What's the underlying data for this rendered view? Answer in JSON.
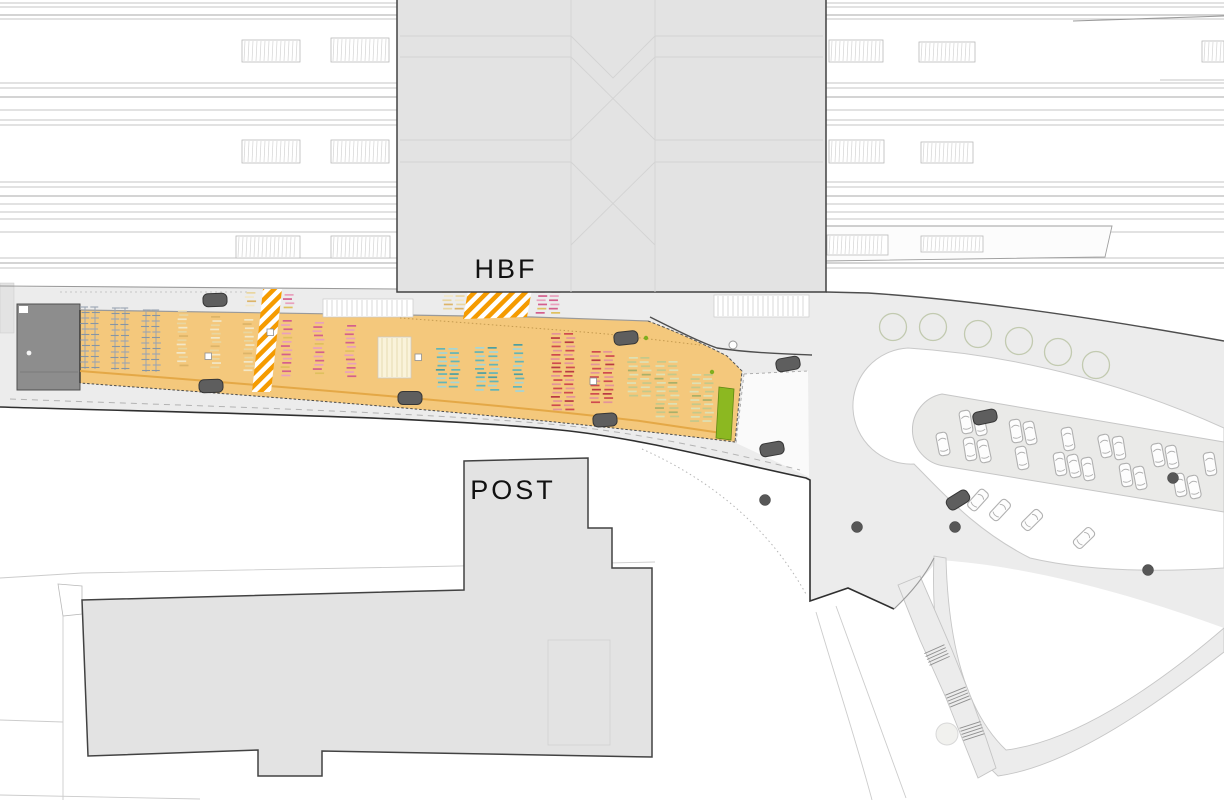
{
  "labels": {
    "hbf": "HBF",
    "post": "POST"
  },
  "colors": {
    "bg": "#ffffff",
    "building": "#e3e3e3",
    "buildingStroke": "#424242",
    "plaza": "#ececec",
    "deck": "#f4c87c",
    "deckLine": "#e2a440",
    "stripe": "#f59b00",
    "green": "#8cb821",
    "darkBox": "#8d8d8d",
    "carDark": "#5e5e5e",
    "tree": "#c2cab0",
    "dot": "#575757",
    "track": "#c6c6c6",
    "trackDark": "#a8a8a8",
    "label": "#111111"
  },
  "plan": {
    "track_segments": [
      [
        0,
        397
      ],
      [
        826,
        1224
      ]
    ],
    "track_ys_light": [
      3,
      7,
      19,
      83,
      88,
      110,
      120,
      125,
      182,
      187,
      204,
      212,
      219,
      232,
      258,
      268
    ],
    "track_ys_dark": [
      15,
      97,
      196,
      263
    ],
    "trains": [
      [
        242,
        40,
        58,
        22
      ],
      [
        331,
        38,
        58,
        24
      ],
      [
        242,
        140,
        58,
        23
      ],
      [
        331,
        140,
        58,
        23
      ],
      [
        236,
        236,
        64,
        22
      ],
      [
        331,
        236,
        59,
        22
      ],
      [
        829,
        40,
        54,
        22
      ],
      [
        919,
        42,
        56,
        20
      ],
      [
        829,
        140,
        55,
        23
      ],
      [
        921,
        142,
        52,
        21
      ],
      [
        827,
        235,
        61,
        20
      ],
      [
        921,
        236,
        62,
        16
      ],
      [
        1202,
        41,
        22,
        21
      ]
    ],
    "trees": [
      [
        893,
        327
      ],
      [
        933,
        327
      ],
      [
        978,
        334
      ],
      [
        1019,
        341
      ],
      [
        1058,
        352
      ],
      [
        1096,
        365
      ]
    ],
    "dots": [
      [
        765,
        500
      ],
      [
        857,
        527
      ],
      [
        955,
        527
      ],
      [
        1148,
        570
      ],
      [
        1173,
        478
      ]
    ],
    "green_dots": [
      [
        646,
        338
      ],
      [
        712,
        372
      ]
    ],
    "cars_dark": [
      [
        215,
        300,
        -2
      ],
      [
        211,
        386,
        -2
      ],
      [
        410,
        398,
        0
      ],
      [
        626,
        338,
        -6
      ],
      [
        788,
        364,
        -10
      ],
      [
        605,
        420,
        -4
      ],
      [
        772,
        449,
        -10
      ],
      [
        985,
        417,
        -12
      ],
      [
        958,
        500,
        -32
      ]
    ],
    "cars_island": [
      [
        966,
        422,
        -10
      ],
      [
        980,
        424,
        -12
      ],
      [
        1016,
        431,
        -9
      ],
      [
        1030,
        433,
        -11
      ],
      [
        1068,
        439,
        -10
      ],
      [
        1105,
        446,
        -12
      ],
      [
        1119,
        448,
        -9
      ],
      [
        1158,
        455,
        -11
      ],
      [
        1172,
        457,
        -10
      ],
      [
        1210,
        464,
        -9
      ],
      [
        943,
        444,
        -11
      ],
      [
        970,
        449,
        -9
      ],
      [
        984,
        451,
        -12
      ],
      [
        1022,
        458,
        -10
      ],
      [
        1060,
        464,
        -9
      ],
      [
        1074,
        466,
        -12
      ],
      [
        1088,
        469,
        -10
      ],
      [
        1126,
        475,
        -9
      ],
      [
        1140,
        478,
        -11
      ],
      [
        1180,
        485,
        -10
      ],
      [
        1194,
        487,
        -12
      ]
    ],
    "cars_taxi": [
      [
        978,
        500,
        42
      ],
      [
        1000,
        510,
        43
      ],
      [
        1032,
        520,
        45
      ],
      [
        1084,
        538,
        46
      ]
    ],
    "stairs": [
      [
        937,
        655,
        -24
      ],
      [
        958,
        697,
        -22
      ],
      [
        972,
        731,
        -18
      ]
    ],
    "stripe_bands": [
      [
        [
          263,
          289
        ],
        [
          282,
          289
        ],
        [
          271,
          392
        ],
        [
          252,
          392
        ]
      ],
      [
        [
          468,
          291
        ],
        [
          532,
          289
        ],
        [
          527,
          317
        ],
        [
          463,
          319
        ]
      ]
    ],
    "markers": [
      [
        208,
        356
      ],
      [
        270,
        332
      ],
      [
        418,
        357
      ],
      [
        593,
        381
      ]
    ],
    "palettes": {
      "rack": [
        "#9aa5b2",
        "#8795a4"
      ],
      "cream": [
        "#e9d6a0",
        "#f2e7c6",
        "#dcb469"
      ],
      "pink": [
        "#d45f8d",
        "#e9a0bd",
        "#dfc05e"
      ],
      "teal": [
        "#62b5b8",
        "#a3d6d7",
        "#4d9fa2"
      ],
      "red": [
        "#cf4a4f",
        "#e4939a",
        "#b93a44"
      ],
      "olive": [
        "#c3c98b",
        "#dde1b5",
        "#a8b06a"
      ]
    },
    "slot_fills": {
      "paleyellow": [
        "#faf3da",
        "#e0d5a8"
      ],
      "white": [
        "#ffffff",
        "#cfcfcf"
      ]
    },
    "bike_groups": [
      {
        "x": 82,
        "y": 307,
        "w": 16,
        "h": 62,
        "type": "rack"
      },
      {
        "x": 112,
        "y": 308,
        "w": 16,
        "h": 62,
        "type": "rack"
      },
      {
        "x": 143,
        "y": 310,
        "w": 18,
        "h": 62,
        "type": "rack"
      },
      {
        "x": 177,
        "y": 310,
        "w": 17,
        "h": 55,
        "type": "bikes",
        "color": "cream"
      },
      {
        "x": 210,
        "y": 316,
        "w": 17,
        "h": 54,
        "type": "bikes",
        "color": "cream"
      },
      {
        "x": 243,
        "y": 319,
        "w": 16,
        "h": 54,
        "type": "bikes",
        "color": "cream"
      },
      {
        "x": 245,
        "y": 292,
        "w": 16,
        "h": 16,
        "type": "bikes",
        "color": "cream"
      },
      {
        "x": 283,
        "y": 294,
        "w": 19,
        "h": 16,
        "type": "bikes",
        "color": "pink"
      },
      {
        "x": 281,
        "y": 320,
        "w": 19,
        "h": 56,
        "type": "bikes",
        "color": "pink"
      },
      {
        "x": 313,
        "y": 322,
        "w": 16,
        "h": 54,
        "type": "bikes",
        "color": "pink"
      },
      {
        "x": 345,
        "y": 325,
        "w": 17,
        "h": 52,
        "type": "bikes",
        "color": "pink"
      },
      {
        "x": 378,
        "y": 337,
        "w": 33,
        "h": 41,
        "type": "slots",
        "fill": "paleyellow"
      },
      {
        "x": 323,
        "y": 299,
        "w": 90,
        "h": 18,
        "type": "slots",
        "fill": "white"
      },
      {
        "x": 714,
        "y": 295,
        "w": 95,
        "h": 22,
        "type": "slots",
        "fill": "white"
      },
      {
        "x": 442,
        "y": 291,
        "w": 23,
        "h": 20,
        "type": "bikes",
        "color": "cream"
      },
      {
        "x": 536,
        "y": 291,
        "w": 25,
        "h": 22,
        "type": "bikes",
        "color": "pink"
      },
      {
        "x": 436,
        "y": 348,
        "w": 26,
        "h": 41,
        "type": "bikes",
        "color": "teal"
      },
      {
        "x": 475,
        "y": 347,
        "w": 27,
        "h": 44,
        "type": "bikes",
        "color": "teal"
      },
      {
        "x": 513,
        "y": 344,
        "w": 18,
        "h": 50,
        "type": "bikes",
        "color": "teal"
      },
      {
        "x": 551,
        "y": 333,
        "w": 30,
        "h": 78,
        "type": "bikes",
        "color": "red"
      },
      {
        "x": 590,
        "y": 351,
        "w": 26,
        "h": 51,
        "type": "bikes",
        "color": "red"
      },
      {
        "x": 627,
        "y": 357,
        "w": 22,
        "h": 38,
        "type": "bikes",
        "color": "olive"
      },
      {
        "x": 655,
        "y": 361,
        "w": 27,
        "h": 55,
        "type": "bikes",
        "color": "olive"
      },
      {
        "x": 690,
        "y": 374,
        "w": 21,
        "h": 47,
        "type": "bikes",
        "color": "olive"
      }
    ]
  }
}
